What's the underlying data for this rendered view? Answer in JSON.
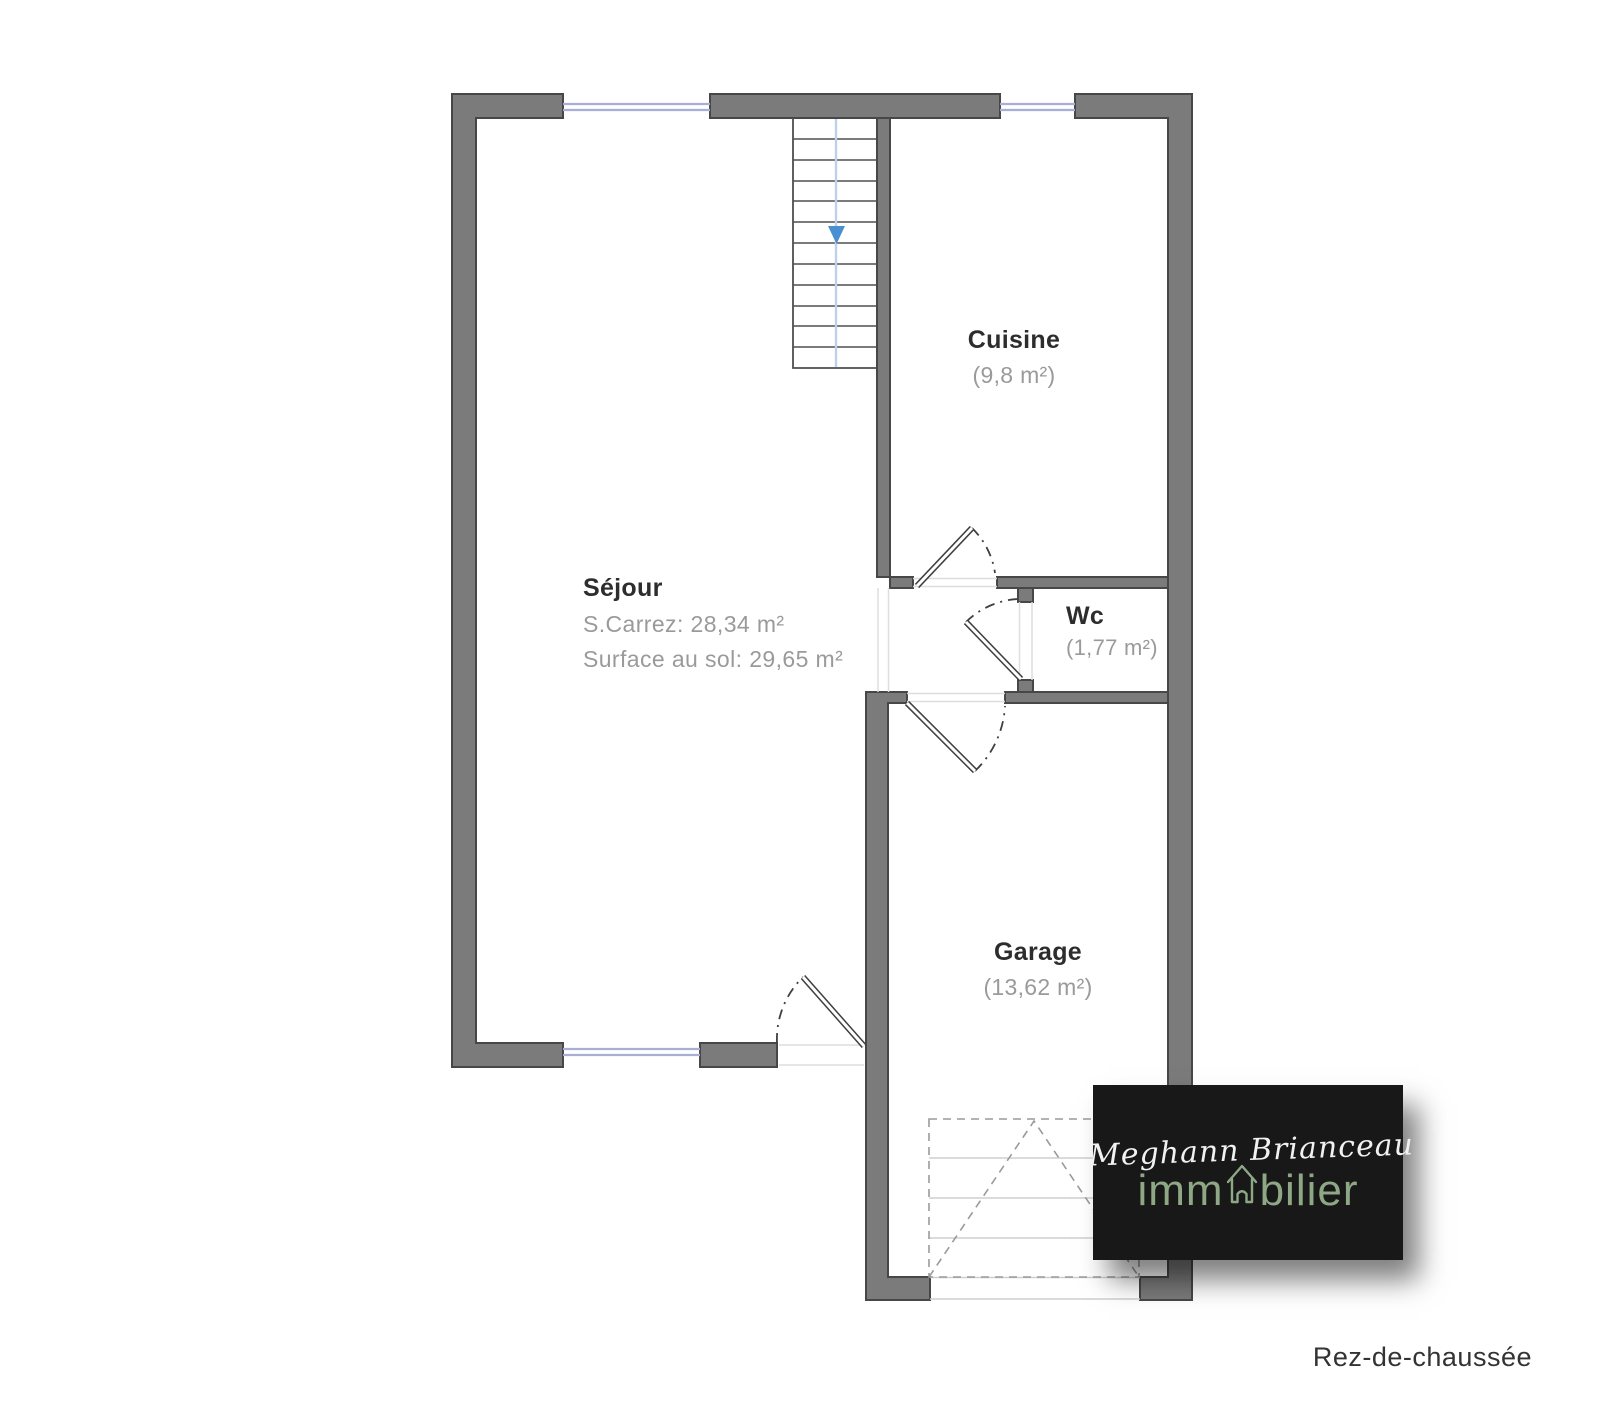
{
  "colors": {
    "wall-fill": "#7b7b7b",
    "wall-stroke": "#474747",
    "window-line": "#a9aed6",
    "stair-arrow": "#4a8fd4",
    "stair-line": "#bcd2e8",
    "logo-bg": "#181818",
    "logo-green": "#8ea886",
    "label-dark": "#2d2d2d",
    "label-gray": "#9a9a9a"
  },
  "rooms": {
    "sejour": {
      "name": "Séjour",
      "detail1": "S.Carrez: 28,34 m²",
      "detail2": "Surface au sol: 29,65 m²"
    },
    "cuisine": {
      "name": "Cuisine",
      "area": "(9,8 m²)"
    },
    "wc": {
      "name": "Wc",
      "area": "(1,77 m²)"
    },
    "garage": {
      "name": "Garage",
      "area": "(13,62 m²)"
    }
  },
  "floor": {
    "label": "Rez-de-chaussée"
  },
  "logo": {
    "script_name": "Meghann Brianceau",
    "word_prefix": "imm",
    "word_suffix": "bilier",
    "house_icon": "house-icon"
  }
}
